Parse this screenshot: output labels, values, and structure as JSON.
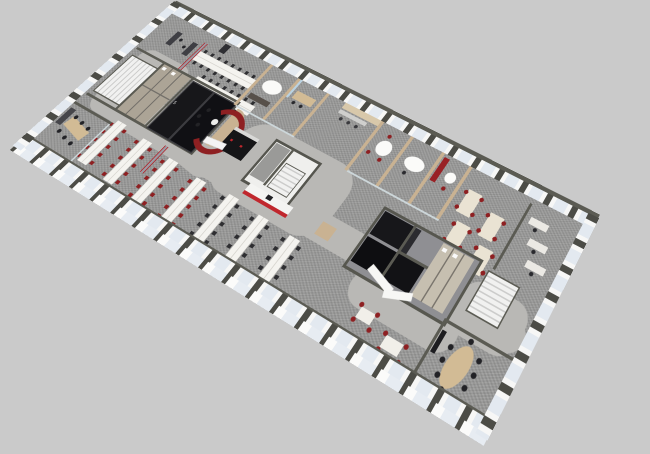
{
  "title": "3D axonometric office floor plan rendering",
  "background": "#cacaca",
  "labels": {
    "room_number": "5"
  },
  "palette": {
    "bg": "#cacaca",
    "wall_cap": "#5b5b53",
    "wall_face": "#f5f5f4",
    "pillar": "#4c4c46",
    "window_glass": "#e3e9f0",
    "carpet": "#9c9c9b",
    "corridor": "#b9b8b5",
    "desk_white": "#f4f3ef",
    "desk_cream": "#eae3d3",
    "chair_red": "#8e2022",
    "chair_dark": "#2e2e31",
    "room_dark": "#141417",
    "wood": "#c9b292",
    "table_tan": "#d2bb95",
    "accent_red": "#c0272d",
    "glass_partition": "#ccd6d9",
    "stair": "#ececec"
  },
  "scene": {
    "type": "isometric-office-floor",
    "elements": [
      "perimeter-window-walls",
      "northwest-staircase",
      "northwest-wc-block",
      "top-desk-benches",
      "wood-meeting-pods",
      "kitchen-pantry",
      "dark-core-rooms",
      "red-curved-booth",
      "vending-cabinets",
      "central-staircase-core",
      "coffee-counter-red-front",
      "right-meeting-pods",
      "right-desk-clusters-red-chairs",
      "right-dark-core-rooms",
      "right-wc-block",
      "southeast-staircase",
      "southeast-conference-room",
      "reception-desk",
      "casual-tables",
      "open-office-bench-rows",
      "west-glass-meeting-room",
      "mobile-partitions-red-trim",
      "whiteboard-screen"
    ]
  }
}
